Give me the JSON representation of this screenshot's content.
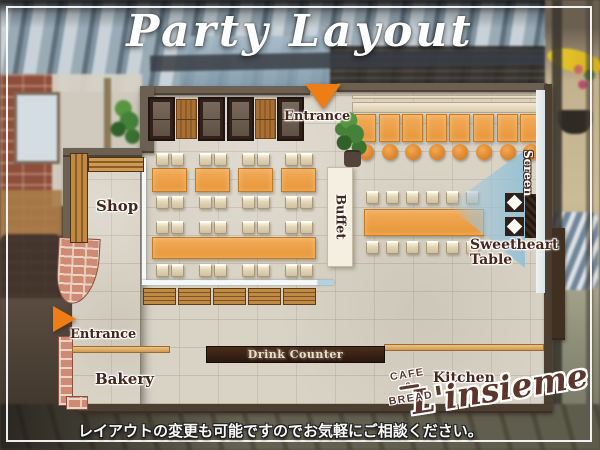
{
  "title": "Party Layout",
  "labels": {
    "entrance_top": "Entrance",
    "entrance_left": "Entrance",
    "shop": "Shop",
    "buffet": "Buffet",
    "screen": "Screen",
    "sweetheart_line1": "Sweetheart",
    "sweetheart_line2": "Table",
    "bakery": "Bakery",
    "kitchen": "Kitchen",
    "drink_counter": "Drink Counter"
  },
  "logo": {
    "name": "L'insieme",
    "tagline": "CAFE & BREAD"
  },
  "footer": {
    "note": "レイアウトの変更も可能ですのでお気軽にご相談ください。"
  },
  "furniture": {
    "booth_sofas": 4,
    "booth_tables": 2,
    "counter_tables": 8,
    "counter_stools": 8,
    "banquet_table_chairs": 12,
    "center_tables": 4,
    "center_table_chairs": 16,
    "center_long_table_chairs": 16,
    "wall_benches": 5,
    "sweetheart_seats": 2
  },
  "colors": {
    "accent_orange": "#ee7d15",
    "table_orange": "#eb9b41",
    "wall_brown": "#6b6052",
    "dark_counter": "#2e1c11",
    "label_brown": "#46251a",
    "beam_blue": "#9fc6da",
    "brick_pink": "#cf8a74",
    "logo_brown": "#5c362a"
  }
}
